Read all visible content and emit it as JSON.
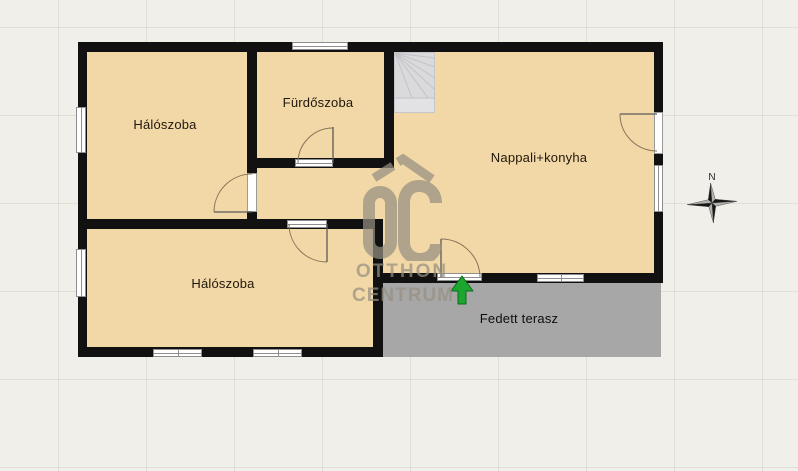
{
  "floorplan": {
    "rooms": {
      "bedroom1": {
        "label": "Hálószoba"
      },
      "bathroom": {
        "label": "Fürdőszoba"
      },
      "living_kitchen": {
        "label": "Nappali+konyha"
      },
      "bedroom2": {
        "label": "Hálószoba"
      },
      "terrace": {
        "label": "Fedett terasz"
      }
    },
    "compass": {
      "north_label": "N"
    },
    "watermark": {
      "logo": "OC",
      "line1": "OTTHON",
      "line2": "CENTRUM"
    },
    "colors": {
      "wall": "#111111",
      "room_fill": "#f2d8a6",
      "terrace_fill": "#a7a7a7",
      "entrance_arrow": "#1ca62e",
      "watermark": "#978f81",
      "stairs_fill": "#dadadd"
    }
  }
}
